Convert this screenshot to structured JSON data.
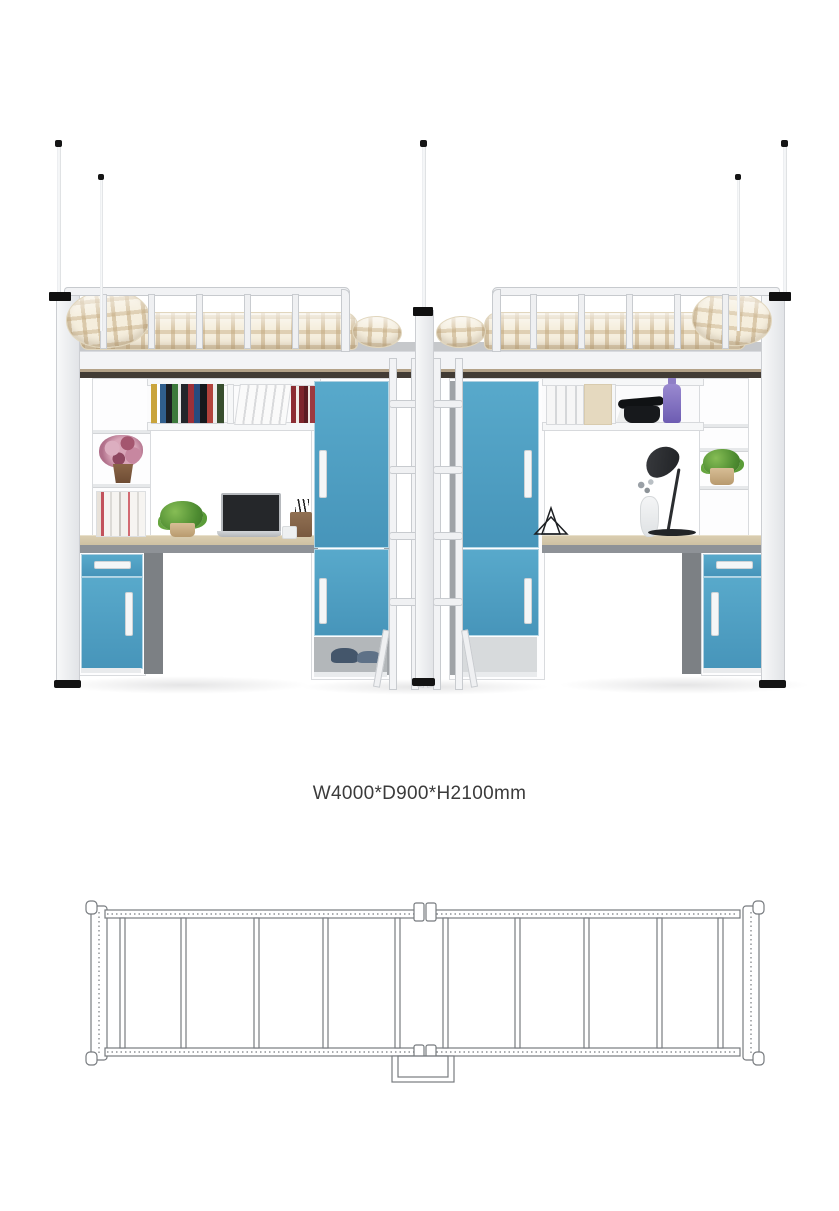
{
  "product": {
    "dimensions_label": "W4000*D900*H2100mm"
  },
  "colors": {
    "accent_blue": "#58a9cb",
    "accent_blue_dark": "#4795ba",
    "frame_white": "#f3f4f6",
    "frame_border": "#c9ccd0",
    "panel_gray": "#7c8084",
    "side_gray": "#9fa3a7",
    "desk_wood": "#cdc0a1",
    "desk_edge": "#8e9297",
    "bedding_base": "#f5eedd",
    "bedding_check": "#c4aa80",
    "mattress_gray": "#c6c8cb",
    "underside_dark": "#423c35",
    "black_accent": "#141414",
    "text_color": "#3b3b3b",
    "diagram_line": "#777b7f",
    "shadow": "rgba(90,90,95,0.16)"
  },
  "plan": {
    "bed_frames": 2,
    "slats_per_frame": 5,
    "ladder_at_center_bottom": true
  }
}
